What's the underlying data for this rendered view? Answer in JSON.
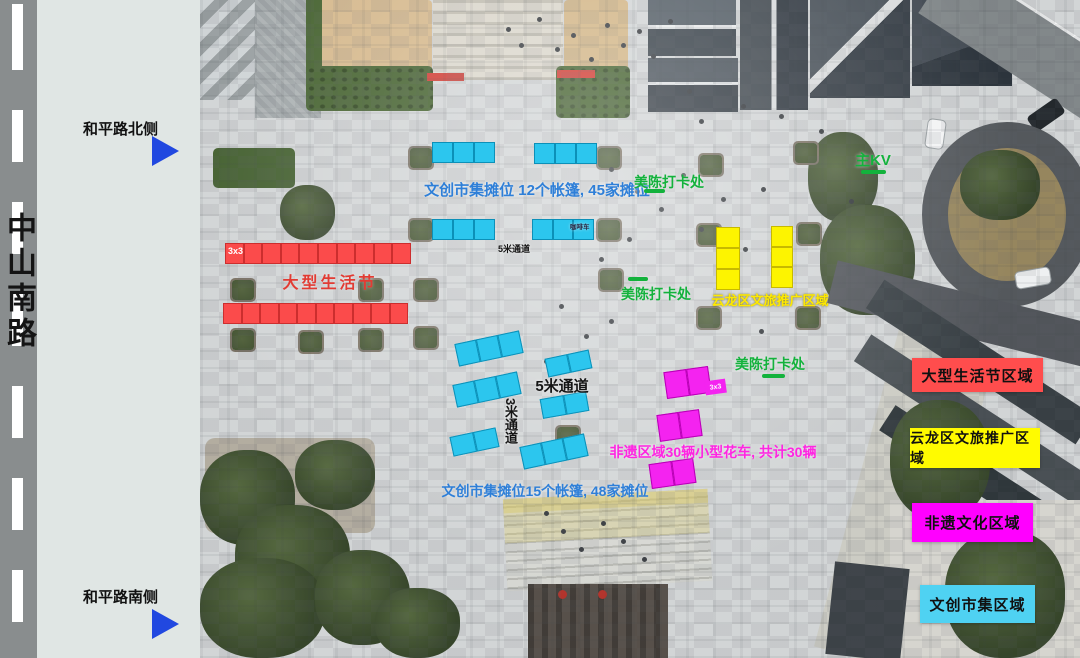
{
  "left_panel": {
    "road_name": "中山南路",
    "north_arrow_label": "和平路北侧",
    "south_arrow_label": "和平路南侧"
  },
  "map": {
    "labels": {
      "market_note_top": "文创市集摊位 12个帐篷, 45家摊位",
      "market_note_bottom": "文创市集摊位15个帐篷, 48家摊位",
      "life_festival": "大型生活节",
      "grid_red": "3x3",
      "grid_magenta": "3x3",
      "aisle_5m_top": "5米通道",
      "aisle_5m_mid": "5米通道",
      "aisle_3m": "3米通道",
      "coffee_cart": "咖啡车",
      "photo_spot": "美陈打卡处",
      "main_kv": "主KV",
      "yunlong_zone": "云龙区文旅推广区域",
      "heritage_note": "非遗区域30辆小型花车, 共计30辆"
    },
    "booths": {
      "styles": {
        "cyan": {
          "fill": "#2cc6ee",
          "stroke": "#0c90b8"
        },
        "red": {
          "fill": "#fb4b4b",
          "stroke": "#cc2e2e"
        },
        "yellow": {
          "fill": "#fdf400",
          "stroke": "#c7b900"
        },
        "magenta": {
          "fill": "#f423f0",
          "stroke": "#b800b5"
        }
      },
      "groups": [
        {
          "type": "cyan",
          "x": 432,
          "y": 142,
          "w": 63,
          "h": 21,
          "cells": 3,
          "dir": "h",
          "rot": 0
        },
        {
          "type": "cyan",
          "x": 534,
          "y": 143,
          "w": 63,
          "h": 21,
          "cells": 3,
          "dir": "h",
          "rot": 0
        },
        {
          "type": "cyan",
          "x": 432,
          "y": 219,
          "w": 63,
          "h": 21,
          "cells": 3,
          "dir": "h",
          "rot": 0
        },
        {
          "type": "cyan",
          "x": 532,
          "y": 219,
          "w": 62,
          "h": 21,
          "cells": 3,
          "dir": "h",
          "rot": 0
        },
        {
          "type": "cyan",
          "x": 456,
          "y": 337,
          "w": 66,
          "h": 23,
          "cells": 3,
          "dir": "h",
          "rot": -12
        },
        {
          "type": "cyan",
          "x": 546,
          "y": 354,
          "w": 45,
          "h": 19,
          "cells": 2,
          "dir": "h",
          "rot": -12
        },
        {
          "type": "cyan",
          "x": 454,
          "y": 378,
          "w": 66,
          "h": 23,
          "cells": 3,
          "dir": "h",
          "rot": -12
        },
        {
          "type": "cyan",
          "x": 541,
          "y": 395,
          "w": 47,
          "h": 20,
          "cells": 2,
          "dir": "h",
          "rot": -10
        },
        {
          "type": "cyan",
          "x": 451,
          "y": 432,
          "w": 47,
          "h": 20,
          "cells": 2,
          "dir": "h",
          "rot": -12
        },
        {
          "type": "cyan",
          "x": 521,
          "y": 440,
          "w": 66,
          "h": 23,
          "cells": 3,
          "dir": "h",
          "rot": -12
        },
        {
          "type": "red",
          "x": 225,
          "y": 243,
          "w": 186,
          "h": 21,
          "cells": 10,
          "dir": "h",
          "rot": 0
        },
        {
          "type": "red",
          "x": 223,
          "y": 303,
          "w": 185,
          "h": 21,
          "cells": 10,
          "dir": "h",
          "rot": 0
        },
        {
          "type": "yellow",
          "x": 716,
          "y": 227,
          "w": 24,
          "h": 63,
          "cells": 3,
          "dir": "v",
          "rot": 0
        },
        {
          "type": "yellow",
          "x": 771,
          "y": 226,
          "w": 22,
          "h": 62,
          "cells": 3,
          "dir": "v",
          "rot": 0
        },
        {
          "type": "magenta",
          "x": 665,
          "y": 369,
          "w": 45,
          "h": 27,
          "cells": 2,
          "dir": "h",
          "rot": -8
        },
        {
          "type": "magenta",
          "x": 658,
          "y": 412,
          "w": 43,
          "h": 27,
          "cells": 2,
          "dir": "h",
          "rot": -8
        },
        {
          "type": "magenta",
          "x": 650,
          "y": 461,
          "w": 45,
          "h": 25,
          "cells": 2,
          "dir": "h",
          "rot": -8
        }
      ]
    }
  },
  "legend": {
    "items": [
      {
        "label": "大型生活节区域",
        "color": "#ff4d4d"
      },
      {
        "label": "云龙区文旅推广区域",
        "color": "#fffb00"
      },
      {
        "label": "非遗文化区域",
        "color": "#ff00ff"
      },
      {
        "label": "文创市集区域",
        "color": "#4fd2f2"
      }
    ]
  },
  "colors": {
    "green_label": "#13b23c",
    "blue_label": "#2e7fd8",
    "red_label": "#e23b33",
    "yellow_label": "#ffe900",
    "magenta_label": "#ff25e2",
    "black_label": "#151515",
    "arrow_blue": "#2148e0"
  }
}
